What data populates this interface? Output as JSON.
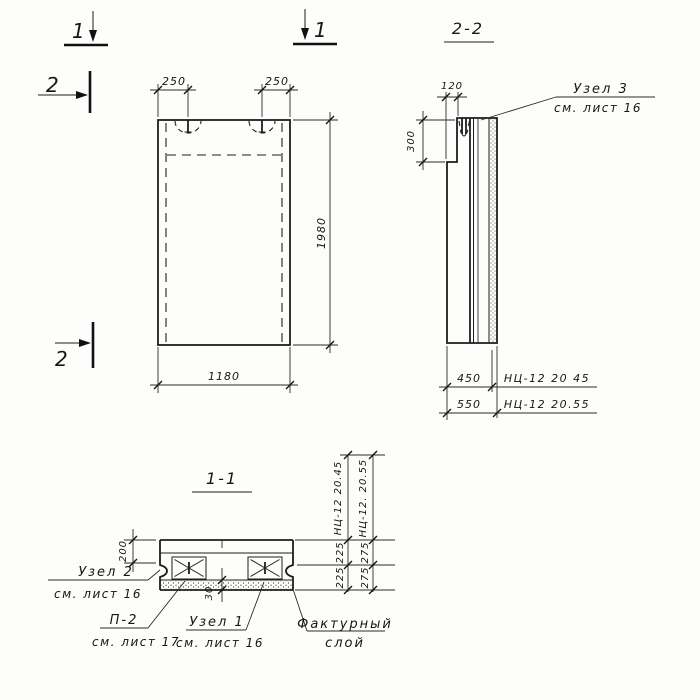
{
  "markers": {
    "sec1_left": "1",
    "sec1_right": "1",
    "sec2_top": "2",
    "sec2_bottom": "2"
  },
  "front_view": {
    "dim_hook_left": "250",
    "dim_hook_right": "250",
    "dim_height": "1980",
    "dim_width": "1180"
  },
  "section_2_2": {
    "title": "2-2",
    "dim_step_width": "120",
    "dim_step_height": "300",
    "node3_label": "Узел 3",
    "node3_ref": "см. лист 16",
    "dim_thick_1": "450",
    "mark_1": "НЦ-12 20 45",
    "dim_thick_2": "550",
    "mark_2": "НЦ-12 20.55"
  },
  "section_1_1": {
    "title": "1-1",
    "dim_top_layer": "200",
    "dim_facing": "30",
    "node2_label": "Узел 2",
    "node2_ref": "см. лист 16",
    "p2_label": "П-2",
    "p2_ref": "см. лист 17",
    "node1_label": "Узел 1",
    "node1_ref": "см. лист 16",
    "facing_label_1": "Фактурный",
    "facing_label_2": "слой",
    "col1_mark": "НЦ-12 20.45",
    "col2_mark": "НЦ-12. 20.55",
    "col1_upper": "225",
    "col1_lower": "225",
    "col2_upper": "275",
    "col2_lower": "275"
  }
}
